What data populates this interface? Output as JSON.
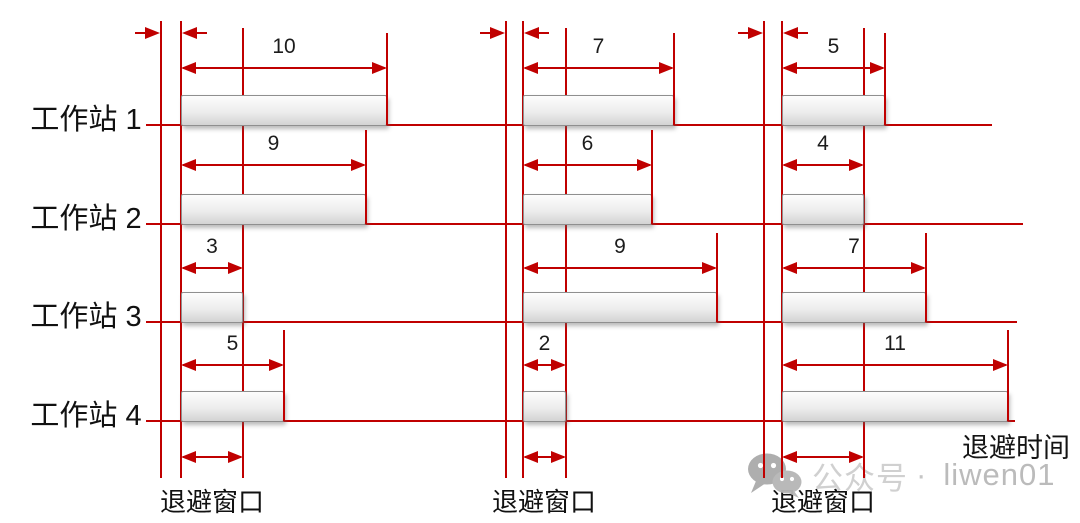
{
  "stations": [
    "工作站 1",
    "工作站 2",
    "工作站 3",
    "工作站 4"
  ],
  "sections": [
    {
      "window_label": "退避窗口",
      "backoffs": [
        10,
        9,
        3,
        5
      ]
    },
    {
      "window_label": "退避窗口",
      "backoffs": [
        7,
        6,
        9,
        2
      ]
    },
    {
      "window_label": "退避窗口",
      "backoffs": [
        5,
        4,
        7,
        11
      ]
    }
  ],
  "axis_label": "退避时间",
  "watermark": {
    "icon": "wechat-icon",
    "text_cn": "公众号",
    "separator": "·",
    "text_latin": "liwen01"
  },
  "colors": {
    "accent_red": "#c00000",
    "bar_border": "#8f8f8f",
    "text": "#1c1c1c",
    "watermark_gray": "#bdbdbd"
  }
}
